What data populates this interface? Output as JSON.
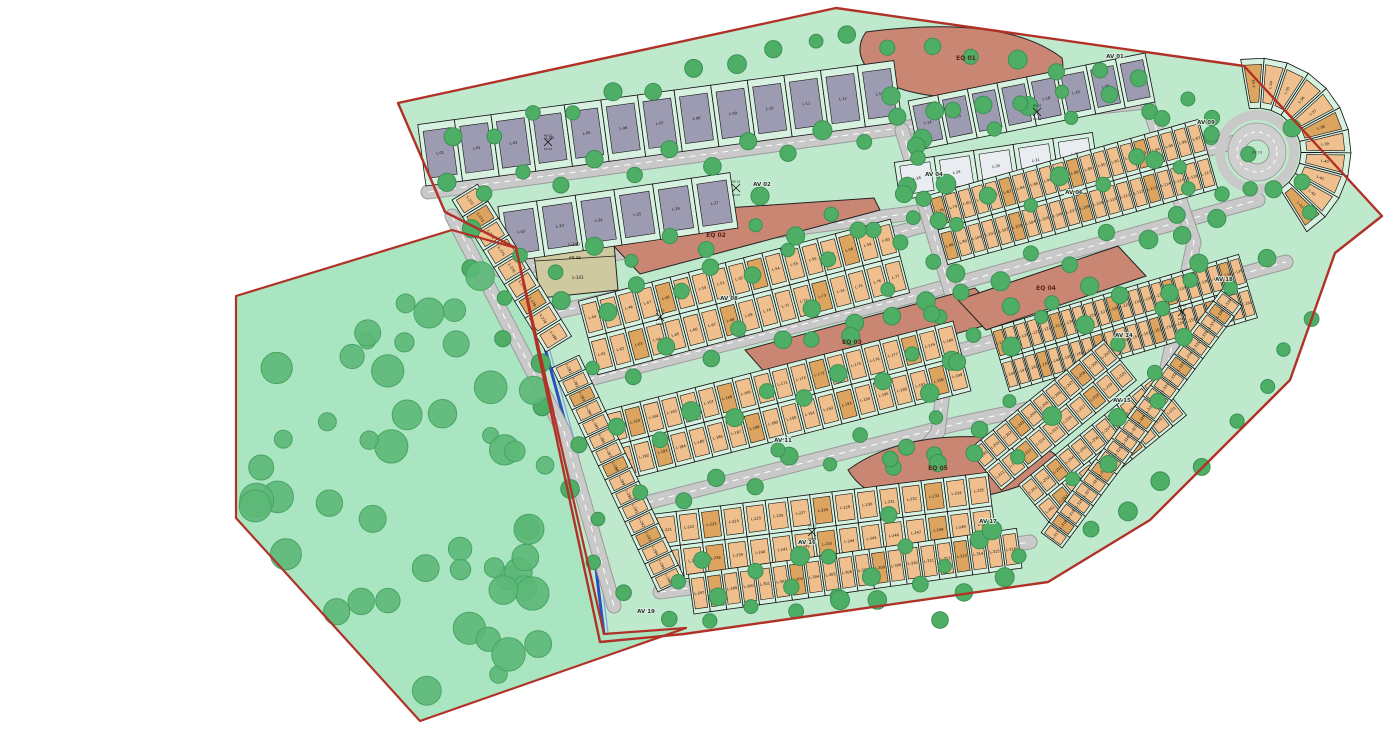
{
  "map": {
    "name": "Residential subdivision site plan",
    "lot_prefix": "L-",
    "numbered_lots_from": 1,
    "numbered_lots_to": 341
  },
  "colors": {
    "park_green": "#a9e5c1",
    "development_green": "#bfe9cd",
    "boundary_red": "#b13127",
    "road_gray": "#c9c9c9",
    "lot_gray": "#9d9bb1",
    "lot_tan": "#efc08d",
    "lot_tan_dark": "#dda45f",
    "lot_pale": "#e9edf2",
    "equipment_salmon": "#c98672",
    "cs_beige": "#cfc9a0",
    "tree_green": "#5cb877",
    "stream_blue": "#2b4fbf",
    "lot_frame_mint": "#d7f1e0"
  },
  "avenues": [
    {
      "id": "av01",
      "label": "AV 01"
    },
    {
      "id": "av02",
      "label": "AV 02"
    },
    {
      "id": "av04",
      "label": "AV 04"
    },
    {
      "id": "av06",
      "label": "AV 06"
    },
    {
      "id": "av08",
      "label": "AV 08"
    },
    {
      "id": "av09",
      "label": "AV 09"
    },
    {
      "id": "av11",
      "label": "AV 11"
    },
    {
      "id": "av14",
      "label": "AV 14"
    },
    {
      "id": "av15",
      "label": "AV 15"
    },
    {
      "id": "av16",
      "label": "AV 16"
    },
    {
      "id": "av17",
      "label": "AV 17"
    },
    {
      "id": "av18",
      "label": "AV 18"
    },
    {
      "id": "av19",
      "label": "AV 19"
    }
  ],
  "roundabout": {
    "label": "AV 10"
  },
  "eq_blocks": [
    {
      "id": "eq01",
      "label": "EQ 01"
    },
    {
      "id": "eq02",
      "label": "EQ 02"
    },
    {
      "id": "eq03",
      "label": "EQ 03"
    },
    {
      "id": "eq04",
      "label": "EQ 04"
    },
    {
      "id": "eq05",
      "label": "EQ 05"
    }
  ],
  "cs_block": {
    "top_lot": "L-340",
    "center_label": "CS 12",
    "bottom_lot": "L-341"
  },
  "markers": [
    {
      "top": "HU 10",
      "bottom": "CS 03"
    },
    {
      "top": "HU 10",
      "bottom": "CS 03"
    },
    {
      "top": "HU 10",
      "bottom": "CS 03"
    },
    {
      "top": "HU 10",
      "bottom": "CS 03"
    },
    {
      "top": "HU 10",
      "bottom": "CS 03"
    },
    {
      "top": "HU 10",
      "bottom": "CS 03"
    }
  ],
  "lot_rows": [
    {
      "id": "rowA",
      "from": 1,
      "to": 13,
      "style": "gray"
    },
    {
      "id": "rowB",
      "from": 14,
      "to": 21,
      "style": "gray"
    },
    {
      "id": "rowC",
      "from": 22,
      "to": 27,
      "style": "gray"
    },
    {
      "id": "rowD",
      "from": 28,
      "to": 32,
      "style": "pale"
    },
    {
      "id": "fan",
      "from": 33,
      "to": 43,
      "style": "tan"
    },
    {
      "id": "t1",
      "from": 44,
      "to": 77,
      "style": "tan"
    },
    {
      "id": "t2",
      "from": 78,
      "to": 117,
      "style": "tan"
    },
    {
      "id": "t3",
      "from": 118,
      "to": 161,
      "style": "tan"
    },
    {
      "id": "t4",
      "from": 162,
      "to": 199,
      "style": "tan"
    },
    {
      "id": "d1",
      "from": 200,
      "to": 220,
      "style": "tan"
    },
    {
      "id": "t5",
      "from": 221,
      "to": 250,
      "style": "tan"
    },
    {
      "id": "d2",
      "from": 251,
      "to": 271,
      "style": "tan"
    },
    {
      "id": "e1",
      "from": 272,
      "to": 280,
      "style": "tan"
    },
    {
      "id": "e2",
      "from": 281,
      "to": 296,
      "style": "tan"
    },
    {
      "id": "s1",
      "from": 297,
      "to": 316,
      "style": "tan"
    },
    {
      "id": "r1",
      "from": 317,
      "to": 339,
      "style": "tan"
    }
  ]
}
